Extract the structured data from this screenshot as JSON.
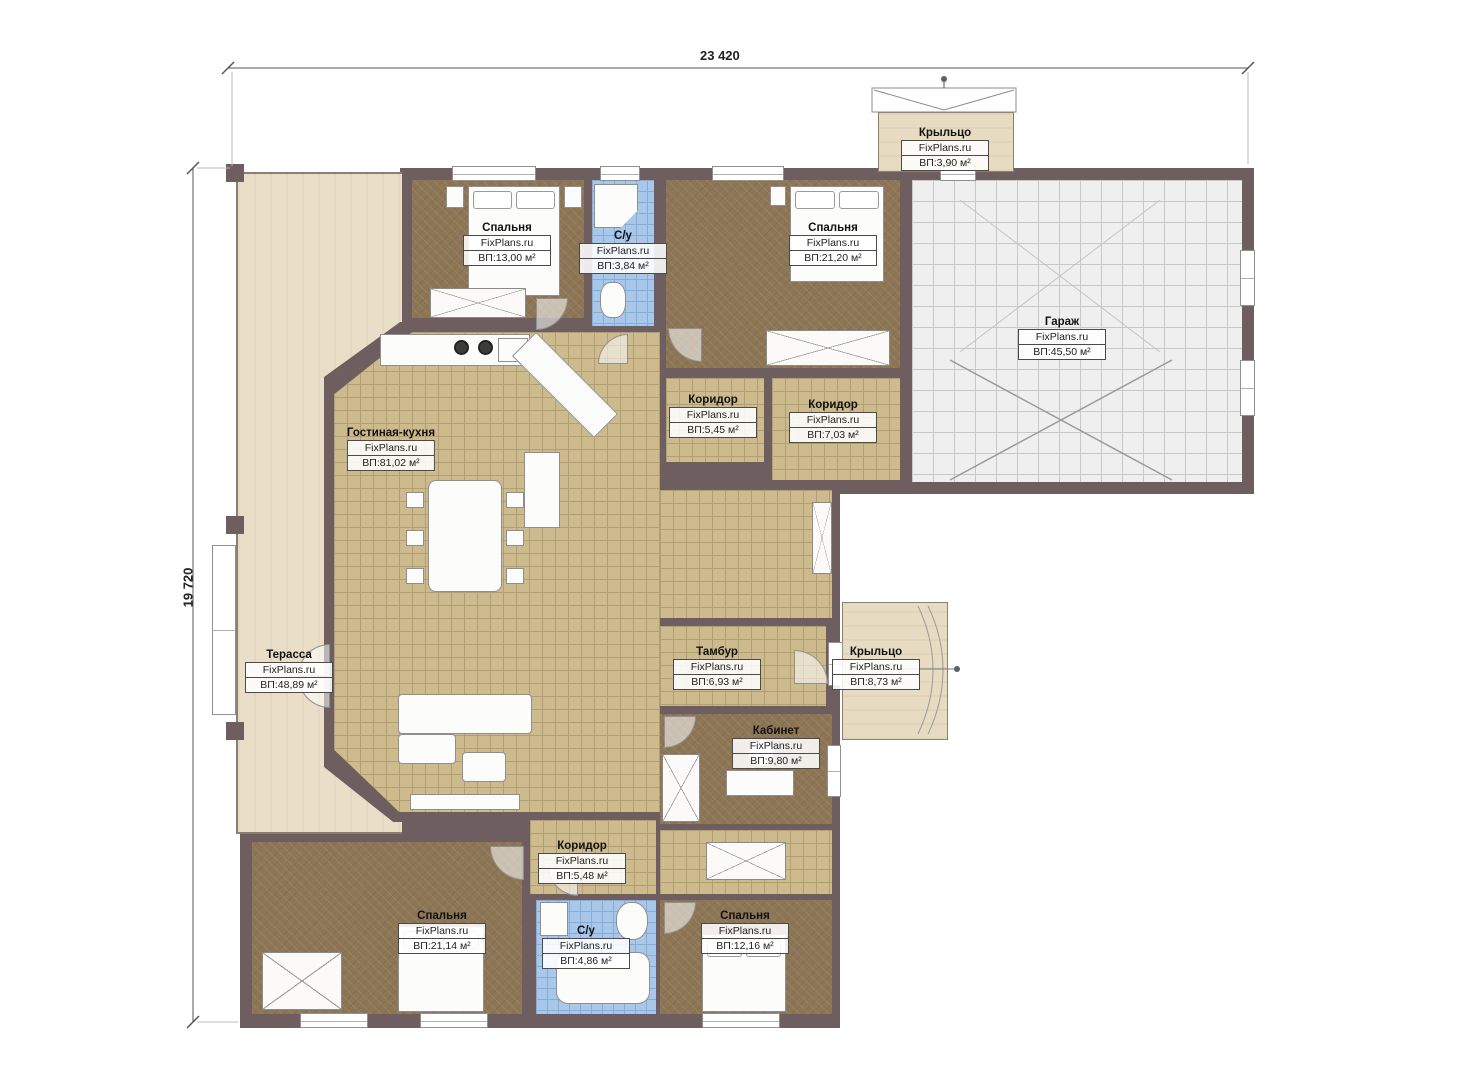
{
  "brand": "FixPlans.ru",
  "dimensions": {
    "top": "23 420",
    "left": "19 720"
  },
  "rooms": [
    {
      "name": "Крыльцо",
      "area": "ВП:3,90 м²"
    },
    {
      "name": "Спальня",
      "area": "ВП:13,00 м²"
    },
    {
      "name": "С/у",
      "area": "ВП:3,84 м²"
    },
    {
      "name": "Спальня",
      "area": "ВП:21,20 м²"
    },
    {
      "name": "Гараж",
      "area": "ВП:45,50 м²"
    },
    {
      "name": "Коридор",
      "area": "ВП:5,45 м²"
    },
    {
      "name": "Коридор",
      "area": "ВП:7,03 м²"
    },
    {
      "name": "Гостиная-кухня",
      "area": "ВП:81,02 м²"
    },
    {
      "name": "Терасса",
      "area": "ВП:48,89 м²"
    },
    {
      "name": "Тамбур",
      "area": "ВП:6,93 м²"
    },
    {
      "name": "Крыльцо",
      "area": "ВП:8,73 м²"
    },
    {
      "name": "Кабинет",
      "area": "ВП:9,80 м²"
    },
    {
      "name": "Коридор",
      "area": "ВП:5,48 м²"
    },
    {
      "name": "Спальня",
      "area": "ВП:21,14 м²"
    },
    {
      "name": "С/у",
      "area": "ВП:4,86 м²"
    },
    {
      "name": "Спальня",
      "area": "ВП:12,16 м²"
    }
  ],
  "colors": {
    "wall": "#6e5e5f",
    "floor_tile_tan": "#cdba8d",
    "floor_parquet_brown": "#8d7655",
    "floor_tile_blue": "#a9c7e8",
    "terrace_beige": "#e9dfc9",
    "garage_gray": "#f0efef"
  }
}
